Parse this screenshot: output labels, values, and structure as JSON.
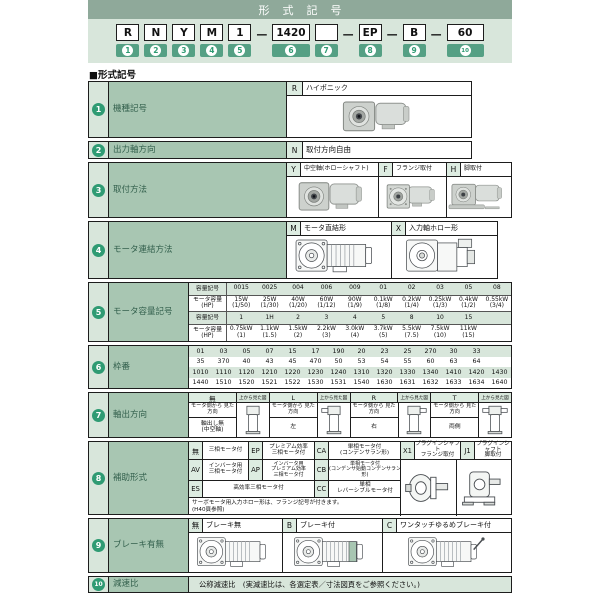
{
  "header": {
    "title": "形式記号",
    "items": [
      {
        "type": "box",
        "label": "R",
        "num": "1"
      },
      {
        "type": "box",
        "label": "N",
        "num": "2"
      },
      {
        "type": "box",
        "label": "Y",
        "num": "3"
      },
      {
        "type": "box",
        "label": "M",
        "num": "4"
      },
      {
        "type": "box",
        "label": "1",
        "num": "5"
      },
      {
        "type": "dash"
      },
      {
        "type": "box",
        "label": "1420",
        "num": "6",
        "wide": true
      },
      {
        "type": "box",
        "label": "",
        "num": "7"
      },
      {
        "type": "dash"
      },
      {
        "type": "box",
        "label": "EP",
        "num": "8"
      },
      {
        "type": "dash"
      },
      {
        "type": "box",
        "label": "B",
        "num": "9"
      },
      {
        "type": "dash"
      },
      {
        "type": "box",
        "label": "60",
        "num": "10",
        "wide": true
      }
    ]
  },
  "section_heading": "■形式記号",
  "row1": {
    "num": "1",
    "label": "機種記号",
    "code": "R",
    "desc": "ハイポニック"
  },
  "row2": {
    "num": "2",
    "label": "出力軸方向",
    "code": "N",
    "desc": "取付方向自由"
  },
  "row3": {
    "num": "3",
    "label": "取付方法",
    "items": [
      {
        "code": "Y",
        "desc": "中空軸(ホローシャフト)"
      },
      {
        "code": "F",
        "desc": "フランジ取付"
      },
      {
        "code": "H",
        "desc": "脚取付"
      }
    ]
  },
  "row4": {
    "num": "4",
    "label": "モータ連結方法",
    "items": [
      {
        "code": "M",
        "desc": "モータ直結形"
      },
      {
        "code": "X",
        "desc": "入力軸ホロー形"
      }
    ]
  },
  "row5": {
    "num": "5",
    "label": "モータ容量記号",
    "tables": [
      {
        "header_label": "容量記号",
        "codes": [
          "0015",
          "0025",
          "004",
          "006",
          "009",
          "01",
          "02",
          "03",
          "05",
          "08"
        ],
        "value_label": [
          "モータ容量",
          "(HP)"
        ],
        "values": [
          [
            "15W",
            "(1/50)"
          ],
          [
            "25W",
            "(1/30)"
          ],
          [
            "40W",
            "(1/20)"
          ],
          [
            "60W",
            "(1/12)"
          ],
          [
            "90W",
            "(1/9)"
          ],
          [
            "0.1kW",
            "(1/8)"
          ],
          [
            "0.2kW",
            "(1/4)"
          ],
          [
            "0.25kW",
            "(1/3)"
          ],
          [
            "0.4kW",
            "(1/2)"
          ],
          [
            "0.55kW",
            "(3/4)"
          ]
        ]
      },
      {
        "header_label": "容量記号",
        "codes": [
          "1",
          "1H",
          "2",
          "3",
          "4",
          "5",
          "8",
          "10",
          "15",
          ""
        ],
        "value_label": [
          "モータ容量",
          "(HP)"
        ],
        "values": [
          [
            "0.75kW",
            "(1)"
          ],
          [
            "1.1kW",
            "(1.5)"
          ],
          [
            "1.5kW",
            "(2)"
          ],
          [
            "2.2kW",
            "(3)"
          ],
          [
            "3.0kW",
            "(4)"
          ],
          [
            "3.7kW",
            "(5)"
          ],
          [
            "5.5kW",
            "(7.5)"
          ],
          [
            "7.5kW",
            "(10)"
          ],
          [
            "11kW",
            "(15)"
          ],
          [
            "",
            ""
          ]
        ]
      }
    ]
  },
  "row6": {
    "num": "6",
    "label": "枠番",
    "grid": [
      [
        "01",
        "03",
        "05",
        "07",
        "15",
        "17",
        "190",
        "20",
        "23",
        "25",
        "270",
        "30",
        "33",
        ""
      ],
      [
        "35",
        "370",
        "40",
        "43",
        "45",
        "470",
        "50",
        "53",
        "54",
        "55",
        "60",
        "63",
        "64",
        ""
      ],
      [
        "1010",
        "1110",
        "1120",
        "1210",
        "1220",
        "1230",
        "1240",
        "1310",
        "1320",
        "1330",
        "1340",
        "1410",
        "1420",
        "1430"
      ],
      [
        "1440",
        "1510",
        "1520",
        "1521",
        "1522",
        "1530",
        "1531",
        "1540",
        "1630",
        "1631",
        "1632",
        "1633",
        "1634",
        "1640"
      ]
    ]
  },
  "row7": {
    "num": "7",
    "label": "軸出方向",
    "top_view_label": "上から見た図",
    "view_label": "モータ側から\n見た方向",
    "cols": [
      {
        "code": "無",
        "dir": "軸出し無\n(中空軸)"
      },
      {
        "code": "L",
        "dir": "左"
      },
      {
        "code": "R",
        "dir": "右"
      },
      {
        "code": "T",
        "dir": "両側"
      }
    ]
  },
  "row8": {
    "num": "8",
    "label": "補助形式",
    "r1": [
      {
        "code": "無",
        "desc": "三相モータ付"
      },
      {
        "code": "EP",
        "desc": "プレミアム効率\n三相モータ付"
      },
      {
        "code": "CA",
        "desc": "単相モータ付\n(コンデンサラン形)"
      },
      {
        "code": "X1",
        "desc": "プラグインシャフト\nフランジ取付"
      },
      {
        "code": "J1",
        "desc": "プラグインシャフト\n脚取付"
      }
    ],
    "r2": [
      {
        "code": "AV",
        "desc": "インバータ用\n三相モータ付"
      },
      {
        "code": "AP",
        "desc": "インバータ用\nプレミアム効率\n三相モータ付"
      },
      {
        "code": "CB",
        "desc": "単相モータ付\n(コンデンサ始動コンデンサラン形)"
      }
    ],
    "r3": [
      {
        "code": "ES",
        "desc": "高効率三相モータ付"
      },
      {
        "code": "CC",
        "desc": "単相\nレバーシブルモータ付"
      }
    ],
    "note": "サーボモータ用入力ホロー形は、フランジ記号が付きます。\n(H40頁参照)"
  },
  "row9": {
    "num": "9",
    "label": "ブレーキ有無",
    "items": [
      {
        "code": "無",
        "desc": "ブレーキ無"
      },
      {
        "code": "B",
        "desc": "ブレーキ付"
      },
      {
        "code": "C",
        "desc": "ワンタッチゆるめブレーキ付"
      }
    ]
  },
  "row10": {
    "num": "10",
    "label": "減速比",
    "desc": "公称減速比　(実減速比は、各選定表／寸法図頁をご参照ください。)"
  },
  "colors": {
    "title_bar_green": "#8fa99a",
    "panel_green": "#d8e6db",
    "chip_green": "#55a084",
    "number_circle_green": "#2f9b73",
    "label_cell_green": "#a8c6b2",
    "code_cell_green": "#ddece1",
    "border": "#1d1d1d"
  }
}
